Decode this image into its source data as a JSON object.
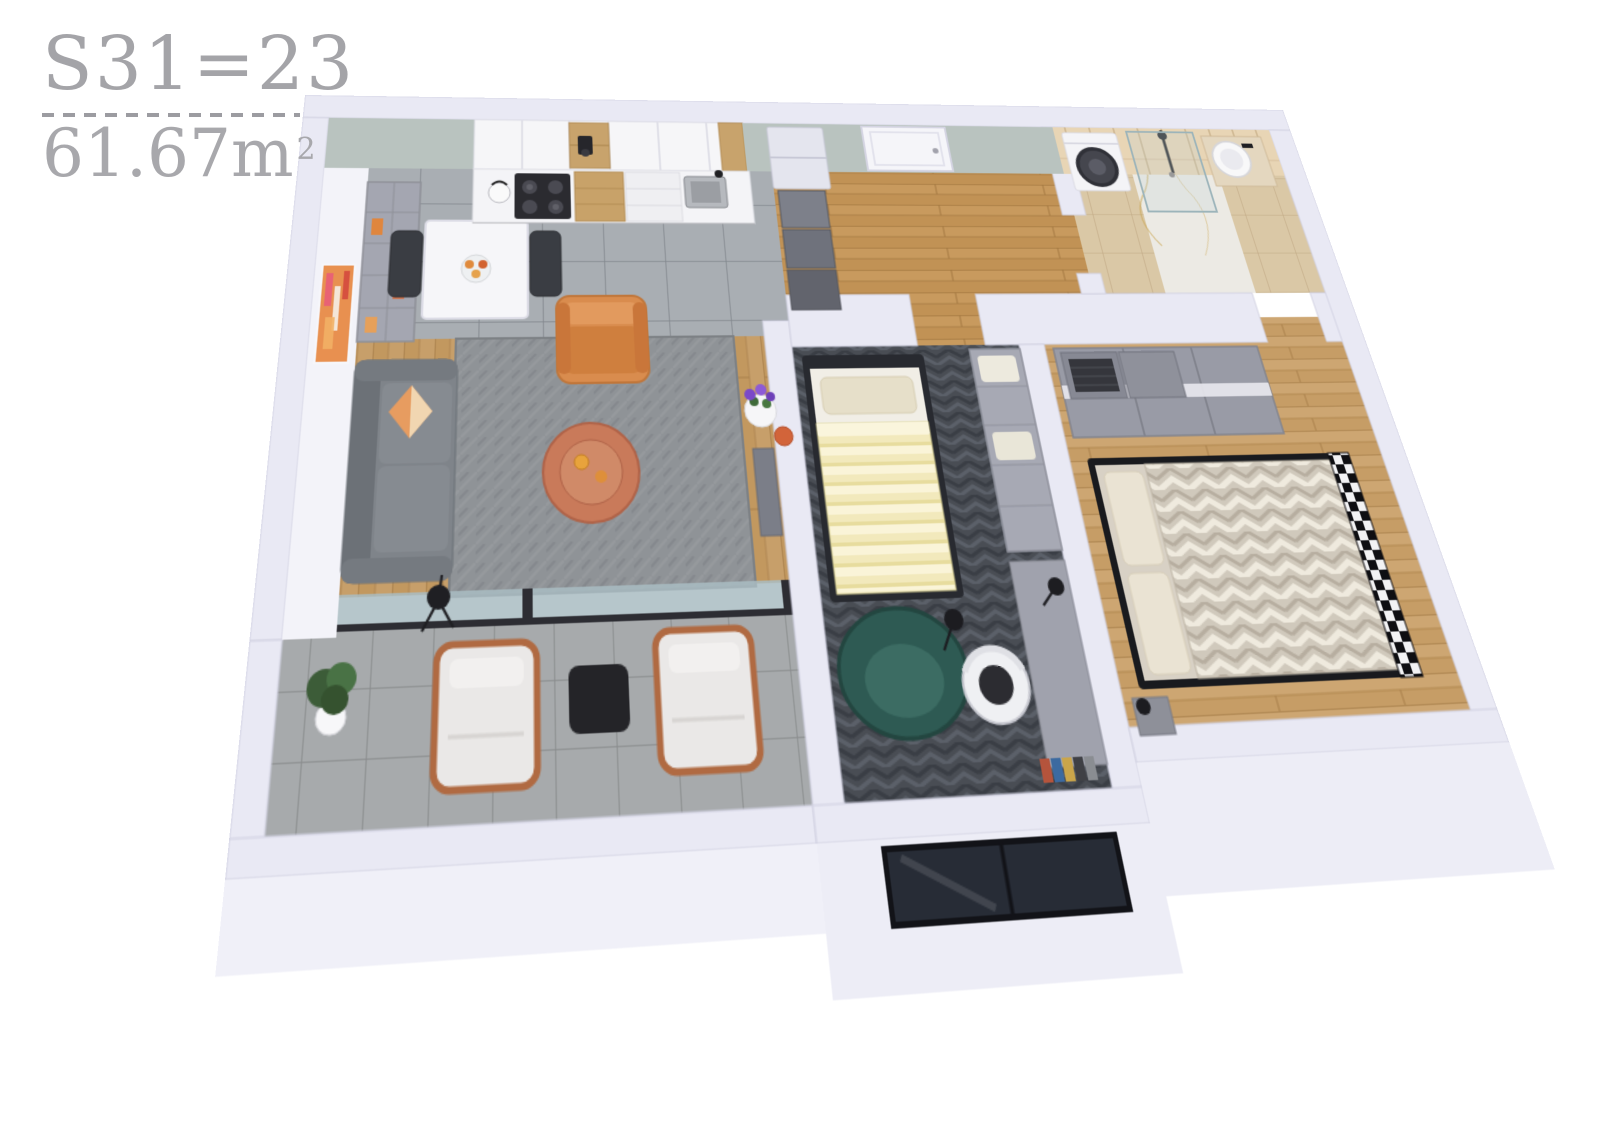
{
  "title": {
    "unit_code": "S31=23",
    "area_number": "61.67",
    "area_unit": "m",
    "area_exponent": "2"
  },
  "palette": {
    "background": "#ffffff",
    "title_text": "#a4a4a8",
    "wall_top": "#e9e9f4",
    "wall_face_interior": "#f3f3f9",
    "wall_face_exterior": "#ededf6",
    "sage_wall": "#b9c3bf",
    "backsplash_tile": "#e8d5b5",
    "wood_living": "#c79f6a",
    "wood_hall": "#c89a5e",
    "wood_bedroom": "#cda672",
    "tile_gray": "#a9aeb3",
    "tile_balcony": "#a7aaac",
    "rug_gray": "#8f9397",
    "carpet_dark": "#494d54",
    "sofa_gray": "#7f848a",
    "pillow_orange": "#e79c60",
    "armchair_orange": "#d98c4e",
    "coffee_table_copper": "#c97a5a",
    "teal_armchair": "#2e5a53",
    "blanket_yellow": "#f2e9bc",
    "bed_blanket_chevron": "#d0c9bc",
    "frame_black": "#1c1c20",
    "cabinet_white": "#f4f4f7",
    "wardrobe_gray": "#999ba6",
    "glass_blue": "#a9bcc2"
  },
  "scene": {
    "type": "3d-apartment-floor-plan-render",
    "rooms": [
      {
        "name": "living-room",
        "floor": "wood-planks-and-gray-tile",
        "items": [
          "gray-sofa",
          "orange-geometric-pillow",
          "floor-lamp",
          "cube-bookshelf",
          "wall-art-orange",
          "dining-table",
          "fruit-bowl",
          "black-dining-chairs",
          "orange-armchair",
          "round-copper-coffee-table",
          "gray-area-rug",
          "purple-flower-pot",
          "orange-vase",
          "console-panel"
        ]
      },
      {
        "name": "kitchen",
        "floor": "gray-tile",
        "items": [
          "upper-cabinets-white",
          "open-shelf-coffee-machine",
          "tile-backsplash",
          "cooktop-with-kettle",
          "oven",
          "wood-drawers",
          "open-shelves",
          "steel-sink",
          "fridge"
        ]
      },
      {
        "name": "entry-hall",
        "floor": "wood-planks",
        "items": [
          "entry-door",
          "stepped-gray-shelving"
        ]
      },
      {
        "name": "bathroom",
        "floor": "tan-tile-and-marble",
        "items": [
          "washing-machine",
          "walk-in-shower",
          "black-shower-fixture",
          "round-basin-vanity"
        ]
      },
      {
        "name": "kids-bedroom",
        "floor": "dark-herringbone-carpet",
        "items": [
          "single-bed-yellow-striped-blanket",
          "beige-pillow",
          "teal-armchair",
          "floor-lamp",
          "cubby-shelf-unit",
          "desk",
          "desk-lamp",
          "white-office-chair",
          "window-south",
          "book-row"
        ]
      },
      {
        "name": "master-bedroom",
        "floor": "wood-planks",
        "items": [
          "sliding-door-wardrobe",
          "storage-baskets",
          "double-bed-chevron-blanket",
          "beige-pillows",
          "black-checkered-footboard",
          "nightstand",
          "tripod-lamp"
        ]
      },
      {
        "name": "balcony",
        "floor": "concrete-tiles",
        "items": [
          "potted-plant",
          "lounge-chair-west",
          "black-side-table",
          "lounge-chair-east",
          "sliding-glass-door"
        ]
      }
    ]
  }
}
